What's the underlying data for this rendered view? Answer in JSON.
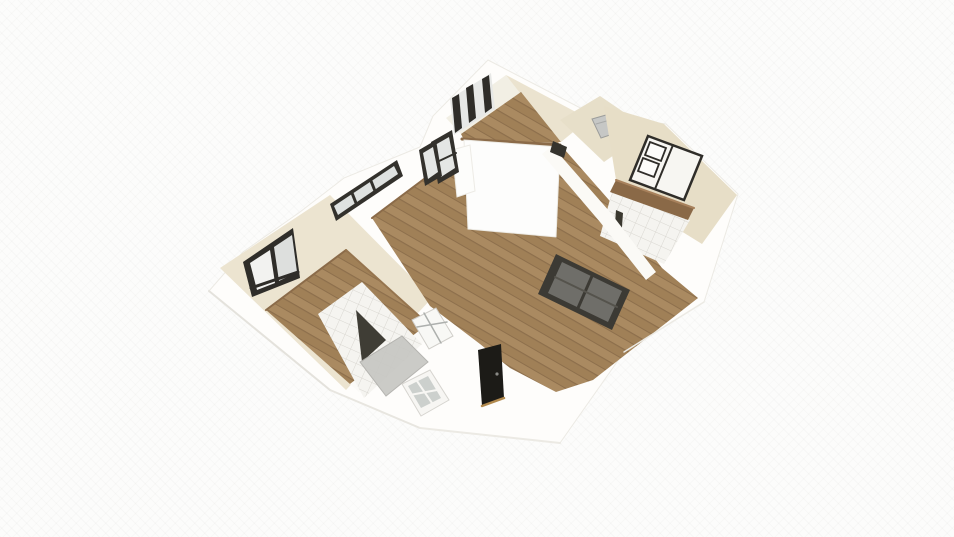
{
  "scene": {
    "view": "3d-floorplan-birdseye",
    "canvas": {
      "width": 954,
      "height": 537
    },
    "rooms": [
      {
        "label": "bedroom-left",
        "floor": "wood"
      },
      {
        "label": "bathroom-left",
        "floor": "tile"
      },
      {
        "label": "living-room",
        "floor": "wood"
      },
      {
        "label": "room-top",
        "floor": "wood"
      },
      {
        "label": "hallway",
        "floor": "beige"
      },
      {
        "label": "bedroom-right",
        "floor": "beige"
      },
      {
        "label": "bathroom-right",
        "floor": "tile"
      }
    ],
    "furniture": [
      "bed",
      "pillows",
      "dresser",
      "washing-machine",
      "shower-screen"
    ],
    "palette": {
      "bg": "#fcfcfb",
      "wall_white": "#fefdfb",
      "wall_bright": "#fdfdfc",
      "cream": "#ece4d0",
      "cream_light": "#f2efe4",
      "beige": "#e7dec7",
      "beige_corridor": "#e7dfc9",
      "wood_base": "#aa8a61",
      "wood_mid": "#a08057",
      "wood_line": "#8d6f4c",
      "wood_edge": "#8b6b49",
      "tile_base": "#f5f4f0",
      "tile_line": "#d9d7d1",
      "frame_dark": "#2f2d29",
      "glass_light": "#e5e7e5",
      "glass_gray": "#6f6e69",
      "slider_frame": "#3c3a34",
      "door_black": "#1c1b17",
      "sill_wood": "#b28a4e",
      "appliance_gray": "#c6c7c5",
      "shower_dark": "#3f3d35",
      "shower_gray": "#c7c7c3",
      "edge_soft": "#e6e4de"
    },
    "shapes": [
      {
        "name": "building-outline",
        "type": "polygon",
        "points": "488,60 592,114 666,124 738,194 704,302 624,352 560,443 420,428 330,390 209,291 243,252 300,212 344,178 420,147 433,116",
        "fill": "#fefdfb",
        "stroke": "#eceae4",
        "w": 1,
        "i": false
      },
      {
        "name": "bedroom-left-interior-walls",
        "type": "polygon",
        "points": "220,268 330,195 432,298 346,390",
        "fill": "#ece4d0",
        "i": false
      },
      {
        "name": "bedroom-left-floor",
        "type": "polygon",
        "points": "266,310 346,250 428,324 350,384",
        "fill": "pattern:wood",
        "i": true
      },
      {
        "name": "bedroom-left-wall-base-nw",
        "type": "line",
        "x1": 266,
        "y1": 310,
        "x2": 346,
        "y2": 250,
        "stroke": "#8b6b49",
        "w": 2,
        "i": false
      },
      {
        "name": "bedroom-left-wall-base-ne",
        "type": "line",
        "x1": 346,
        "y1": 250,
        "x2": 428,
        "y2": 324,
        "stroke": "#96754f",
        "w": 2,
        "i": false
      },
      {
        "name": "wall-band-bedroom-bath",
        "type": "polygon",
        "points": "350,384 428,324 437,332 359,392",
        "fill": "#fbfaf7",
        "i": false
      },
      {
        "name": "bathroom-left-floor",
        "type": "polygon",
        "points": "318,314 362,282 422,344 364,398",
        "fill": "pattern:tile",
        "i": true
      },
      {
        "name": "living-room-floor",
        "type": "polygon",
        "points": "372,218 460,152 473,145 558,142 616,208 662,268 698,298 593,380 556,392 510,368 480,344 430,306",
        "fill": "pattern:wood",
        "i": true
      },
      {
        "name": "living-wall-base-nw",
        "type": "line",
        "x1": 372,
        "y1": 218,
        "x2": 460,
        "y2": 152,
        "stroke": "#8b6b49",
        "w": 2,
        "i": false
      },
      {
        "name": "room-top-wall-nw",
        "type": "polygon",
        "points": "446,118 506,75 521,92 461,134",
        "fill": "#f2efe4",
        "i": false
      },
      {
        "name": "room-top-window-glass",
        "type": "polygon",
        "points": "450,99 491,73 495,109 454,135",
        "fill": "#e7e8e6",
        "i": false
      },
      {
        "name": "window-top-bar-1",
        "type": "polygon",
        "points": "452,98 459,94 462,128 455,133",
        "fill": "#2f2d29",
        "i": true
      },
      {
        "name": "window-top-bar-2",
        "type": "polygon",
        "points": "466,88 473,84 476,118 469,123",
        "fill": "#2f2d29",
        "i": true
      },
      {
        "name": "window-top-bar-3",
        "type": "polygon",
        "points": "482,79 489,75 492,108 485,113",
        "fill": "#2f2d29",
        "i": true
      },
      {
        "name": "room-top-wall-ne",
        "type": "polygon",
        "points": "506,75 589,119 561,142 520,93",
        "fill": "#ebe3cf",
        "i": false
      },
      {
        "name": "room-top-floor",
        "type": "polygon",
        "points": "461,134 521,92 561,142 466,144",
        "fill": "pattern:wood",
        "i": true
      },
      {
        "name": "room-top-wall-base",
        "type": "line",
        "x1": 462,
        "y1": 139,
        "x2": 560,
        "y2": 145,
        "stroke": "#8b6b49",
        "w": 3,
        "i": false
      },
      {
        "name": "room-top-front-wall",
        "type": "polygon",
        "points": "464,140 560,147 556,237 468,229",
        "fill": "#fdfdfc",
        "stroke": "#edebe5",
        "w": 1,
        "i": false
      },
      {
        "name": "column",
        "type": "polygon",
        "points": "452,150 470,145 475,191 457,197",
        "fill": "#fdfdfb",
        "stroke": "#edebe5",
        "w": 1,
        "i": false
      },
      {
        "name": "hallway-floor",
        "type": "polygon",
        "points": "560,120 600,96 650,130 604,162",
        "fill": "#e7dfc9",
        "i": true
      },
      {
        "name": "washing-machine",
        "type": "polygon",
        "points": "592,119 613,113 622,131 601,138",
        "fill": "#c6c7c5",
        "stroke": "#9c9d9b",
        "w": 1,
        "i": true
      },
      {
        "name": "washing-machine-seam",
        "type": "line",
        "x1": 596,
        "y1": 124,
        "x2": 617,
        "y2": 118,
        "stroke": "#a9aaa8",
        "w": 1,
        "i": false
      },
      {
        "name": "bedroom-right-floor",
        "type": "polygon",
        "points": "604,106 664,124 737,195 702,244 618,192",
        "fill": "#e7dec7",
        "i": true
      },
      {
        "name": "bathroom-right-floor",
        "type": "polygon",
        "points": "612,192 690,220 664,264 600,236",
        "fill": "pattern:tile",
        "i": true
      },
      {
        "name": "dresser-wood",
        "type": "polygon",
        "points": "616,180 694,208 688,220 610,192",
        "fill": "#8a6947",
        "i": true
      },
      {
        "name": "dresser-top-edge",
        "type": "line",
        "x1": 616,
        "y1": 180,
        "x2": 694,
        "y2": 208,
        "stroke": "#a8815c",
        "w": 2,
        "i": false
      },
      {
        "name": "door-jamb-dark",
        "type": "polygon",
        "points": "616,210 623,213 621,240 614,237",
        "fill": "#3a382f",
        "i": false
      },
      {
        "name": "bed",
        "type": "polygon",
        "points": "648,136 702,156 684,200 630,180",
        "fill": "#f7f6f2",
        "stroke": "#2f2d29",
        "w": 2.5,
        "i": true
      },
      {
        "name": "bed-pillow",
        "type": "polygon",
        "points": "650,142 666,148 661,161 645,155",
        "fill": "#fcfcfa",
        "stroke": "#2f2d29",
        "w": 1.8,
        "i": true
      },
      {
        "name": "bed-pillow-2",
        "type": "polygon",
        "points": "643,158 659,164 654,177 638,171",
        "fill": "#fcfcfa",
        "stroke": "#2f2d29",
        "w": 1.8,
        "i": true
      },
      {
        "name": "bed-blanket-line",
        "type": "line",
        "x1": 673,
        "y1": 145,
        "x2": 655,
        "y2": 189,
        "stroke": "#2f2d29",
        "w": 2,
        "i": false
      },
      {
        "name": "wall-band-living-right",
        "type": "polygon",
        "points": "552,146 610,212 656,272 646,280 600,222 542,154",
        "fill": "#fbfaf6",
        "i": false
      },
      {
        "name": "window-small-dark",
        "type": "polygon",
        "points": "553,141 567,147 564,158 550,152",
        "fill": "#35332d",
        "i": true
      },
      {
        "name": "slider-window-frame",
        "type": "polygon",
        "points": "556,254 630,290 612,330 538,294",
        "fill": "#3c3a34",
        "i": true
      },
      {
        "name": "slider-window-glass",
        "type": "polygon",
        "points": "562,262 622,291 608,322 548,293",
        "fill": "#6f6e69",
        "i": false
      },
      {
        "name": "slider-mullion-v",
        "type": "line",
        "x1": 592,
        "y1": 276,
        "x2": 578,
        "y2": 308,
        "stroke": "#3c3a34",
        "w": 3,
        "i": false
      },
      {
        "name": "slider-mullion-h",
        "type": "line",
        "x1": 555,
        "y1": 277,
        "x2": 617,
        "y2": 307,
        "stroke": "#55534c",
        "w": 2,
        "i": false
      },
      {
        "name": "entry-door-black",
        "type": "polygon",
        "points": "478,350 501,344 504,398 482,406",
        "fill": "#1c1b17",
        "i": true
      },
      {
        "name": "entry-door-sill",
        "type": "line",
        "x1": 482,
        "y1": 406,
        "x2": 504,
        "y2": 398,
        "stroke": "#b28a4e",
        "w": 2.5,
        "i": false
      },
      {
        "name": "entry-door-knob",
        "type": "circle",
        "cx": 497,
        "cy": 374,
        "r": 1.6,
        "fill": "#8a8a86",
        "i": false
      },
      {
        "name": "shower-door-glass-dark",
        "type": "polygon",
        "points": "356,310 386,340 362,362",
        "fill": "#3f3d35",
        "i": true
      },
      {
        "name": "shower-screen-glass",
        "type": "polygon",
        "points": "360,362 402,336 428,362 386,396",
        "fill": "#c7c7c3",
        "stroke": "#b0afab",
        "w": 1,
        "op": 0.92,
        "i": true
      },
      {
        "name": "glazed-door-white",
        "type": "polygon",
        "points": "412,320 436,308 453,336 429,349",
        "fill": "#f8f8f5",
        "stroke": "#d0cec9",
        "w": 1,
        "i": true
      },
      {
        "name": "glazed-door-mullion-1",
        "type": "line",
        "x1": 424,
        "y1": 313,
        "x2": 441,
        "y2": 343,
        "stroke": "#adb0ad",
        "w": 1.5,
        "i": false
      },
      {
        "name": "glazed-door-mullion-2",
        "type": "line",
        "x1": 417,
        "y1": 327,
        "x2": 447,
        "y2": 322,
        "stroke": "#adb0ad",
        "w": 1.5,
        "i": false
      },
      {
        "name": "window-bottom-frame",
        "type": "polygon",
        "points": "402,384 430,370 449,400 421,416",
        "fill": "#f7f6f3",
        "stroke": "#d6d4cf",
        "w": 1,
        "i": true
      },
      {
        "name": "window-bottom-glass",
        "type": "polygon",
        "points": "408,386 428,376 441,398 421,408",
        "fill": "#ccd0cd",
        "i": false
      },
      {
        "name": "window-bottom-mullion-v",
        "type": "line",
        "x1": 417,
        "y1": 381,
        "x2": 432,
        "y2": 403,
        "stroke": "#f7f6f3",
        "w": 2,
        "i": false
      },
      {
        "name": "window-bottom-mullion-h",
        "type": "line",
        "x1": 410,
        "y1": 395,
        "x2": 437,
        "y2": 390,
        "stroke": "#f7f6f3",
        "w": 2,
        "i": false
      },
      {
        "name": "window-long-frame",
        "type": "polygon",
        "points": "330,204 397,160 403,176 336,221",
        "fill": "#33312c",
        "i": true
      },
      {
        "name": "window-long-glass",
        "type": "polygon",
        "points": "334,206 394,166 398,174 338,215",
        "fill": "#dfe2e0",
        "i": false
      },
      {
        "name": "window-long-mullion-1",
        "type": "line",
        "x1": 352,
        "y1": 193,
        "x2": 356,
        "y2": 203,
        "stroke": "#33312c",
        "w": 3,
        "i": false
      },
      {
        "name": "window-long-mullion-2",
        "type": "line",
        "x1": 371,
        "y1": 181,
        "x2": 375,
        "y2": 191,
        "stroke": "#33312c",
        "w": 3,
        "i": false
      },
      {
        "name": "window-tall-frame",
        "type": "polygon",
        "points": "431,142 452,130 459,172 438,184",
        "fill": "#33312c",
        "i": true
      },
      {
        "name": "window-tall-glass",
        "type": "polygon",
        "points": "435,145 449,137 455,168 441,177",
        "fill": "#e4e6e4",
        "i": false
      },
      {
        "name": "window-tall-mullion",
        "type": "line",
        "x1": 437,
        "y1": 162,
        "x2": 456,
        "y2": 153,
        "stroke": "#33312c",
        "w": 2,
        "i": false
      },
      {
        "name": "window-mid-frame",
        "type": "polygon",
        "points": "419,150 436,140 442,176 425,186",
        "fill": "#33312c",
        "i": true
      },
      {
        "name": "window-mid-glass",
        "type": "polygon",
        "points": "423,153 433,147 438,172 428,179",
        "fill": "#e4e6e4",
        "i": false
      },
      {
        "name": "bedroom-window-frame",
        "type": "polygon",
        "points": "243,262 293,228 300,278 252,297",
        "fill": "#2f2d29",
        "i": true
      },
      {
        "name": "bedroom-window-pane-left",
        "type": "polygon",
        "points": "250,263 270,250 275,283 257,290",
        "fill": "#f2f2f0",
        "i": false
      },
      {
        "name": "bedroom-window-pane-right",
        "type": "polygon",
        "points": "274,247 292,235 297,272 279,281",
        "fill": "#dddfdd",
        "i": false
      },
      {
        "name": "bedroom-window-mullion",
        "type": "line",
        "x1": 272,
        "y1": 249,
        "x2": 277,
        "y2": 282,
        "stroke": "#2f2d29",
        "w": 2.5,
        "i": false
      },
      {
        "name": "bedroom-window-sill-band",
        "type": "line",
        "x1": 251,
        "y1": 288,
        "x2": 298,
        "y2": 272,
        "stroke": "#2f2d29",
        "w": 3,
        "i": false
      },
      {
        "name": "outer-edge-sw",
        "type": "line",
        "x1": 209,
        "y1": 291,
        "x2": 330,
        "y2": 390,
        "stroke": "#e4e2dc",
        "w": 2,
        "i": false
      },
      {
        "name": "outer-edge-s1",
        "type": "line",
        "x1": 330,
        "y1": 390,
        "x2": 420,
        "y2": 428,
        "stroke": "#e8e6e0",
        "w": 2,
        "i": false
      },
      {
        "name": "outer-edge-s2",
        "type": "line",
        "x1": 420,
        "y1": 428,
        "x2": 560,
        "y2": 443,
        "stroke": "#eceae4",
        "w": 2,
        "i": false
      },
      {
        "name": "outer-edge-se",
        "type": "line",
        "x1": 704,
        "y1": 302,
        "x2": 624,
        "y2": 352,
        "stroke": "#eceae4",
        "w": 1.5,
        "i": false
      }
    ]
  }
}
